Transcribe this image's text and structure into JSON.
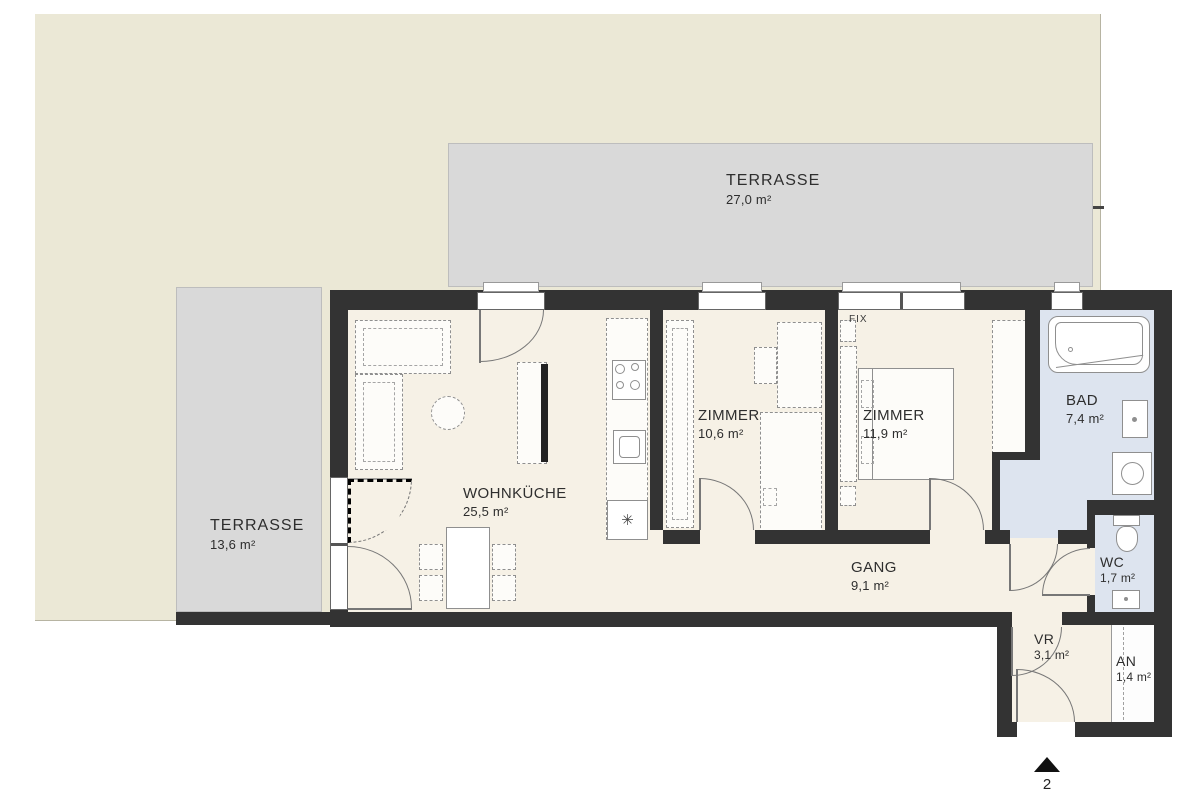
{
  "rooms": {
    "terrace_top": {
      "name": "TERRASSE",
      "area": "27,0 m²"
    },
    "terrace_left": {
      "name": "TERRASSE",
      "area": "13,6 m²"
    },
    "wohnkueche": {
      "name": "WOHNKÜCHE",
      "area": "25,5 m²"
    },
    "zimmer_1": {
      "name": "ZIMMER",
      "area": "10,6 m²"
    },
    "zimmer_2": {
      "name": "ZIMMER",
      "area": "11,9 m²"
    },
    "bad": {
      "name": "BAD",
      "area": "7,4 m²"
    },
    "gang": {
      "name": "GANG",
      "area": "9,1 m²"
    },
    "wc": {
      "name": "WC",
      "area": "1,7 m²"
    },
    "vr": {
      "name": "VR",
      "area": "3,1 m²"
    },
    "an": {
      "name": "AN",
      "area": "1,4 m²"
    }
  },
  "annotations": {
    "fix_label": "FIX",
    "entrance_unit_number": "2",
    "appliance_symbol": "✳"
  },
  "colors": {
    "wall": "#333333",
    "floor": "#f6f1e6",
    "wet_room": "#dde4ef",
    "terrace": "#d9d9d9",
    "garden": "#ebe8d6",
    "furniture_outline": "#8f8f8f"
  }
}
